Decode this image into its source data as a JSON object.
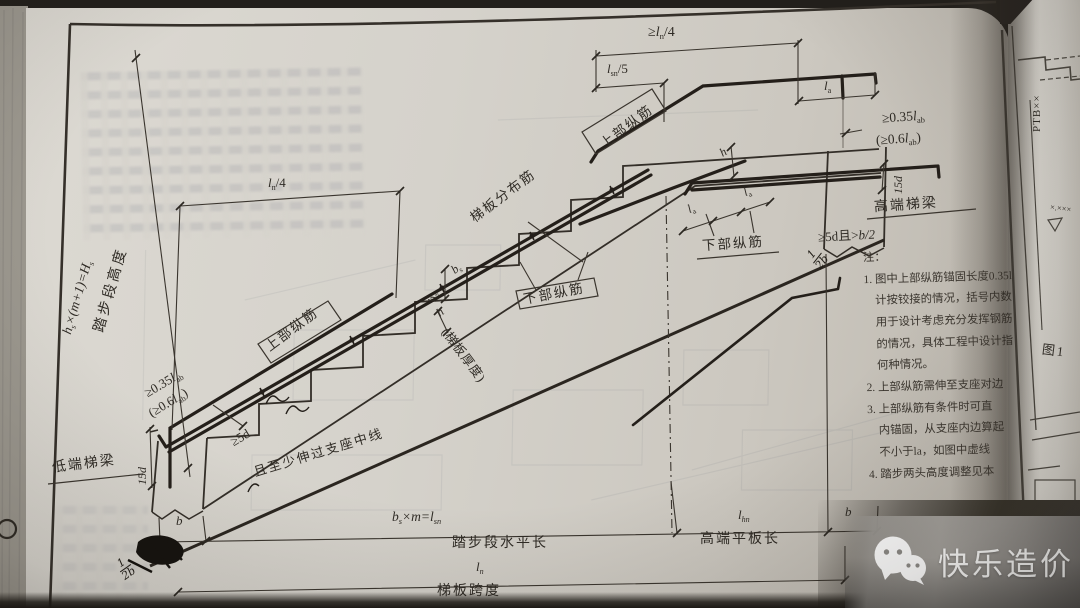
{
  "page": {
    "dims": {
      "ln4_top": {
        "pre": "≥",
        "base": "l",
        "sub": "n",
        "post": "/4"
      },
      "ln4_left": {
        "base": "l",
        "sub": "n",
        "post": "/4"
      },
      "lsn5": {
        "base": "l",
        "sub": "sn",
        "post": "/5"
      },
      "la": {
        "base": "l",
        "sub": "a"
      },
      "anchor_035": {
        "pre": "≥0.35",
        "base": "l",
        "sub": "ab"
      },
      "anchor_06": {
        "pre": "(≥0.6",
        "base": "l",
        "sub": "ab",
        "post": ")"
      },
      "len_15d": "15d",
      "high_5d": {
        "pre": "≥5d且>",
        "frac": "b/2"
      },
      "low_5d": "≥5d",
      "low_5d_note": "且至少伸过支座中线",
      "height_formula": {
        "t1": "h",
        "s1": "s",
        "t2": "×(m+1)=H",
        "s2": "s"
      },
      "height_label": "踏步段高度",
      "b": "b",
      "bs_m": {
        "t1": "b",
        "s1": "s",
        "t2": "×m=l",
        "s2": "sn"
      },
      "run_label": "踏步段水平长",
      "lhn": {
        "base": "l",
        "sub": "hn"
      },
      "flat_label": "高端平板长",
      "ln": {
        "base": "l",
        "sub": "n"
      },
      "span_label": "梯板跨度",
      "bs": {
        "base": "b",
        "sub": "s"
      },
      "hs": {
        "base": "h",
        "sub": "s"
      },
      "h": "h",
      "h_note": "(梯板厚度)"
    },
    "labels": {
      "top_bar": "上部纵筋",
      "dist_bar": "梯板分布筋",
      "bottom_bar": "下部纵筋",
      "low_beam": "低端梯梁",
      "high_beam": "高端梯梁"
    },
    "handwriting": {
      "num": "1",
      "den": "2b"
    },
    "notes": {
      "title": "注：",
      "lines": [
        "1. 图中上部纵筋锚固长度0.35l",
        "计按铰接的情况，括号内数",
        "用于设计考虑充分发挥钢筋",
        "的情况，具体工程中设计指",
        "何种情况。",
        "2. 上部纵筋需伸至支座对边",
        "3. 上部纵筋有条件时可直",
        "内锚固，从支座内边算起",
        "不小于la，如图中虚线",
        "4. 踏步两头高度调整见本"
      ]
    },
    "adjacent": {
      "code": "PTB××",
      "elevation": "×.×××",
      "figure": "图1"
    }
  },
  "watermark": {
    "text": "快乐造价"
  }
}
